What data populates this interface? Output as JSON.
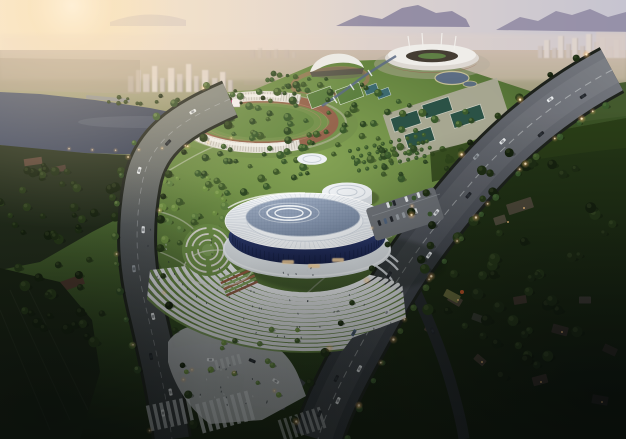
{
  "meta": {
    "type": "architectural-aerial-rendering",
    "time_of_day": "dusk",
    "view": "high oblique aerial of a sports-park complex at sunset"
  },
  "palette": {
    "sky_warm": "#f7e9d4",
    "sky_cool": "#c6c4d0",
    "sun_core": "#fffaf0",
    "sun_glow": "#f7ddb2",
    "mountain": "#837d9a",
    "mountain_far": "#9b93ac",
    "haze": "#ddc9bc",
    "city_light": "#e2dad5",
    "city_dark": "#b4aaa6",
    "water": "#46506a",
    "water_dark": "#333b50",
    "park_light": "#86a456",
    "park_mid": "#64833f",
    "park_dark": "#3f5a2a",
    "tree_dark": "#2e4823",
    "tree_lit": "#6f9143",
    "tree_hi": "#aac473",
    "forest_dark": "#131c0c",
    "forest_mid": "#263917",
    "road_light": "#75787f",
    "road_mid": "#4a4e55",
    "road_dark": "#2f3338",
    "lane": "#d5d8da",
    "plaza": "#b5b8bb",
    "terrace_white": "#e8eaec",
    "terrace_green": "#6f9148",
    "arena_white": "#eef1f4",
    "arena_rib": "#c2cad4",
    "dome_hi": "#9dabc0",
    "dome_lo": "#76869f",
    "glass_hi": "#3e4f8c",
    "glass_deep": "#161f46",
    "track": "#96654d",
    "court": "#2b5246",
    "pitch": "#5d8040",
    "light_warm": "#ffc882",
    "light_core": "#ffedc9",
    "car_white": "#e9ecee",
    "car_dark": "#24272c",
    "car_grey": "#9aa0a6",
    "car_blue": "#52657e",
    "billboard_magenta": "#c2447e",
    "sand": "#c4bd97"
  },
  "scene": {
    "sky": {
      "sun_position": "upper-left",
      "features": [
        "sunset glow",
        "hazy horizon",
        "mountain ridges",
        "distant city skylines"
      ]
    },
    "water": {
      "kind": "river-lake",
      "position": "upper-left",
      "features": [
        "bridge",
        "lit shoreline"
      ]
    },
    "venues": {
      "arena": {
        "kind": "circular gymnasium",
        "roof": "white ribbed ring with paneled dome and circle motif",
        "facade": "navy glass band",
        "landscape": [
          "terraced steps",
          "spiral garden",
          "garden plots",
          "entry plaza"
        ]
      },
      "athletics_stadium": {
        "features": [
          "running track",
          "white lattice grandstand",
          "billboard screen"
        ]
      },
      "main_stadium": {
        "features": [
          "white saddle roof",
          "masts"
        ]
      },
      "aquatic_center": {
        "roof": "white crescent"
      },
      "sports_grounds": [
        "tennis courts",
        "soccer pitches",
        "training track",
        "orchard rows",
        "pond",
        "stream"
      ]
    },
    "roads": {
      "left_boulevard": "curved north-south avenue with street lights",
      "main_avenue": "wide diagonal avenue with street lights and traffic",
      "connector": "junction with zebra crosswalks",
      "branch": "dark residential lane"
    },
    "forest": {
      "position": "east",
      "features": [
        "dark woods",
        "village houses",
        "lit windows"
      ]
    },
    "traffic": {
      "cars": "light and dark vehicles on all avenues",
      "pedestrians": "small figures on plaza and terraces"
    }
  }
}
